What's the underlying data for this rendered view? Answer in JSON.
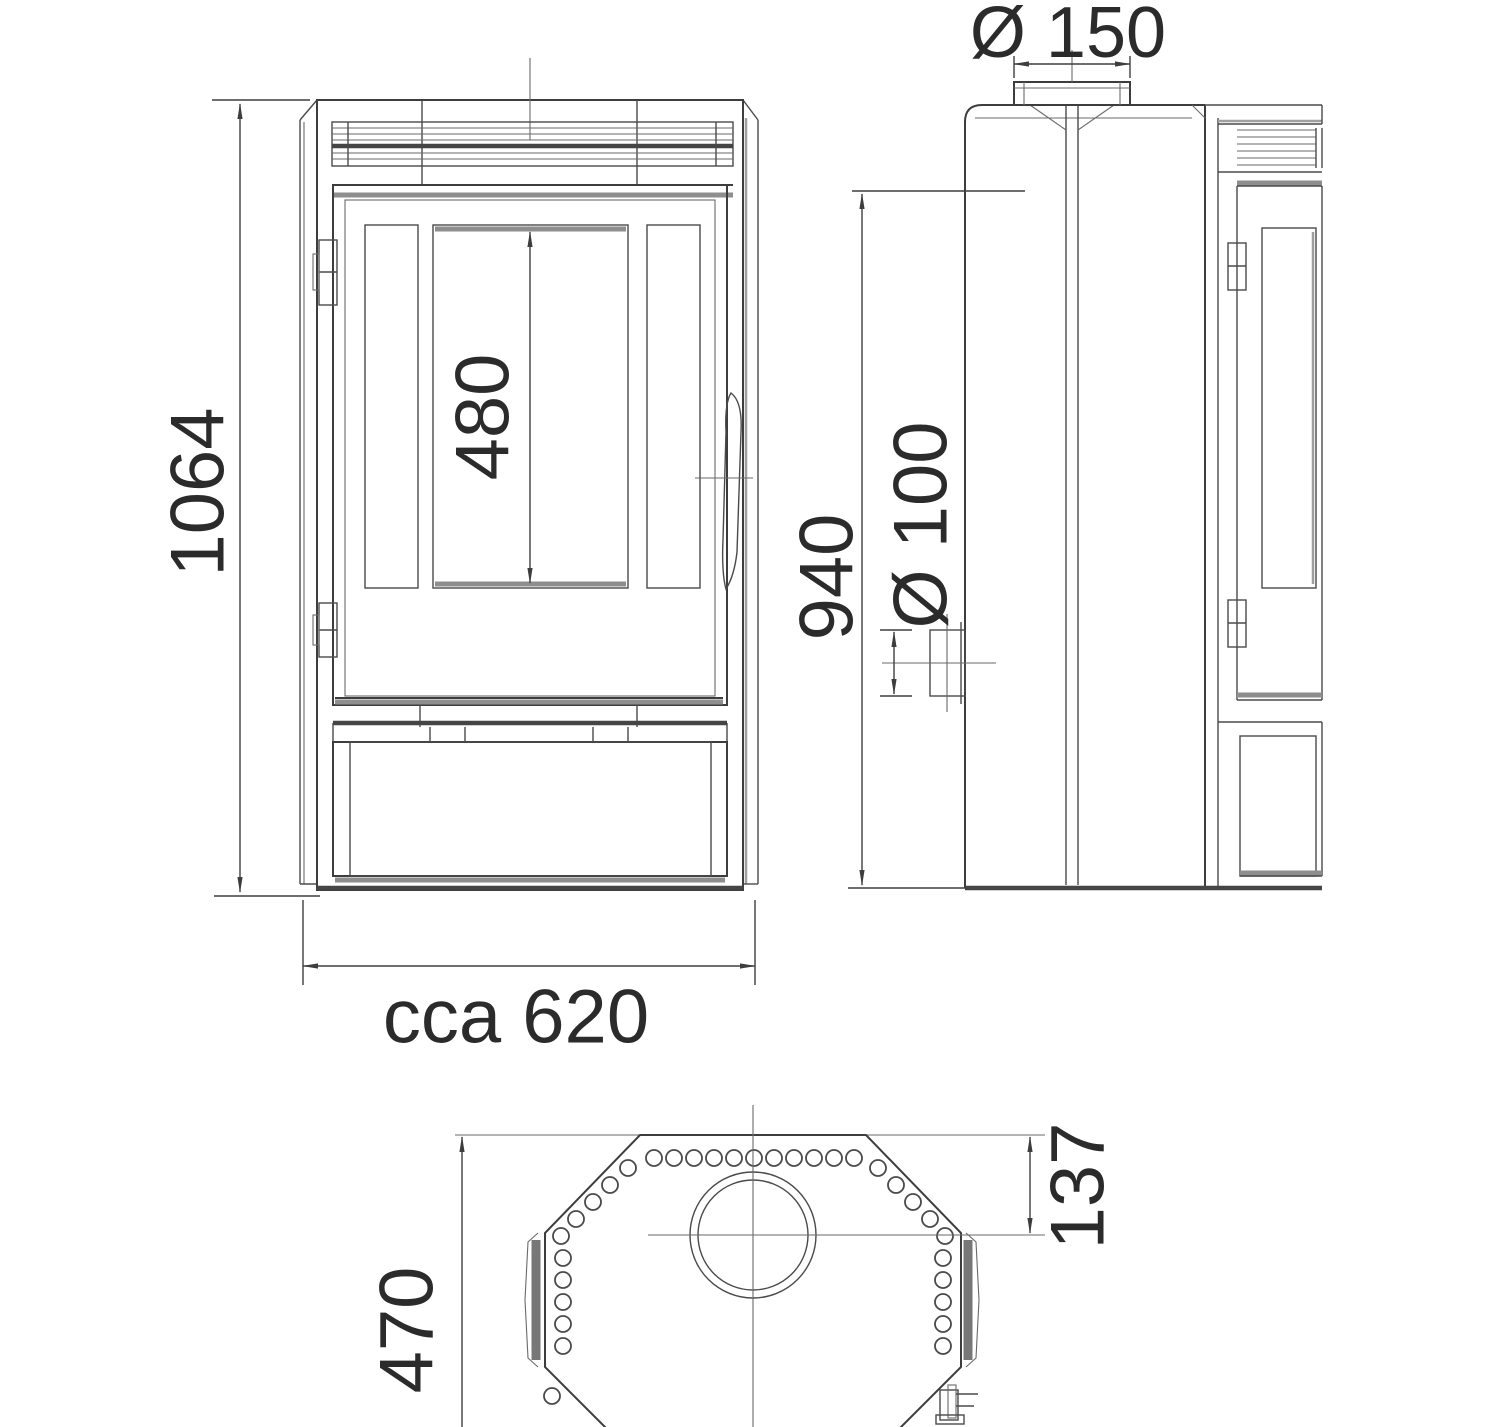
{
  "drawing": {
    "front_view": {
      "overall_height": "1064",
      "glass_height": "480",
      "overall_width": "cca 620"
    },
    "side_view": {
      "flue_collar_diameter": "Ø 150",
      "rear_outlet_height": "940",
      "air_inlet_diameter": "Ø 100"
    },
    "top_view": {
      "depth": "470",
      "flue_center_from_back": "137"
    }
  }
}
